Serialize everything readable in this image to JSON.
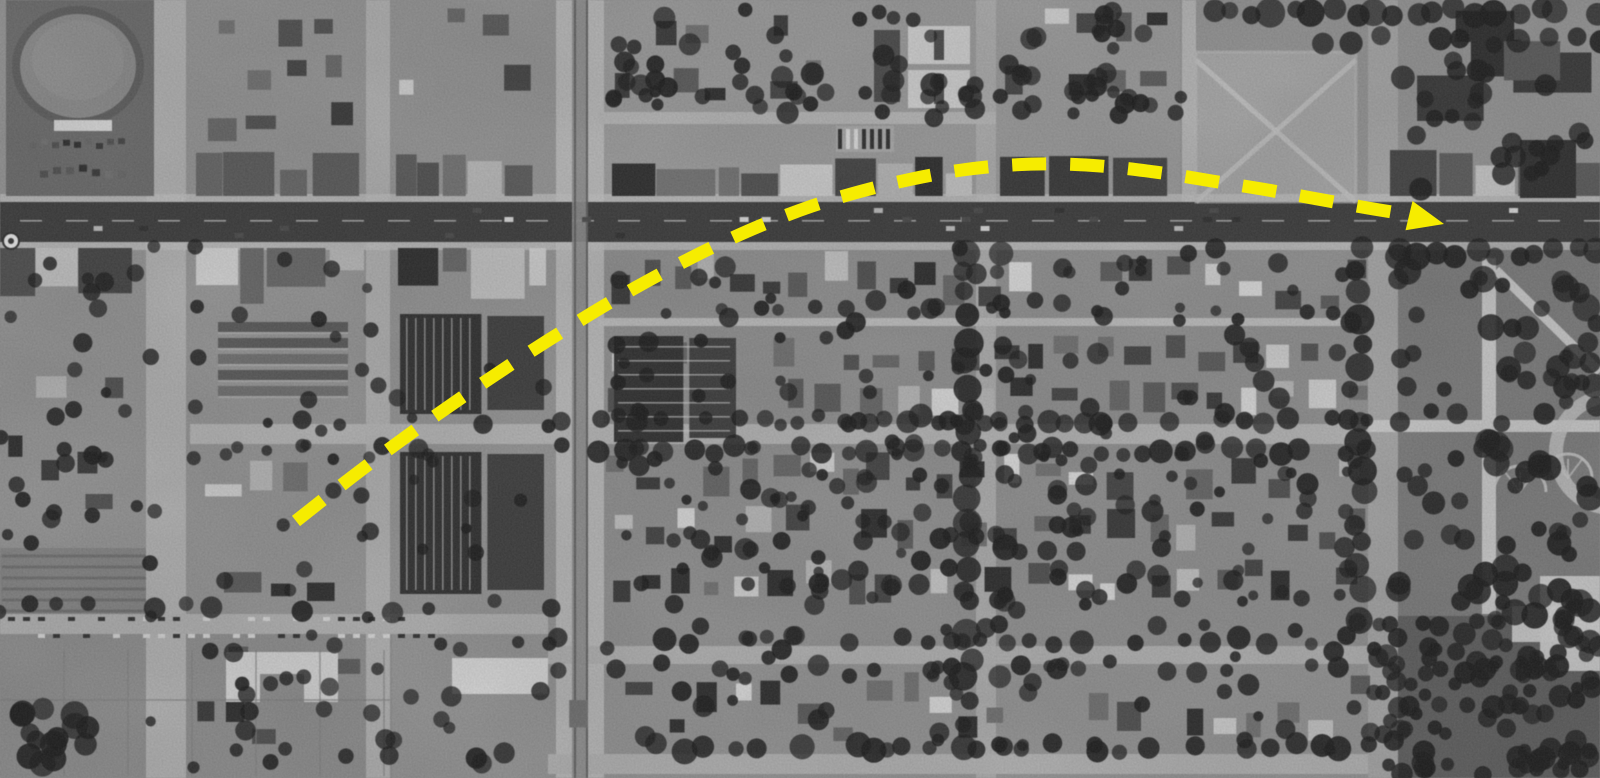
{
  "meta": {
    "kind": "annotated-aerial-photograph",
    "color_mode": "grayscale",
    "width": 1600,
    "height": 778
  },
  "palette": {
    "base": "#949494",
    "road_major": "#3c3c3c",
    "sidewalk": "#c2c2c2",
    "tree": "#1d1d1d",
    "dark_tones": [
      "#2d2d2d",
      "#383838",
      "#434343",
      "#4f4f4f",
      "#5a5a5a",
      "#666666",
      "#717171"
    ],
    "light_tones": [
      "#b7b7b7",
      "#c3c3c3",
      "#cfcfcf",
      "#dadada"
    ],
    "field": "#8d8d8d",
    "park": "#7c7c7c",
    "dark_field": "#5e5e5e",
    "arrow_yellow": "#F6EC00"
  },
  "annotation": {
    "arrow": {
      "color": "#F6EC00",
      "stroke_width": 13,
      "dash_length": 34,
      "gap_length": 24,
      "points": [
        [
          296,
          521
        ],
        [
          352,
          477
        ],
        [
          407,
          436
        ],
        [
          461,
          398
        ],
        [
          513,
          363
        ],
        [
          563,
          331
        ],
        [
          614,
          300
        ],
        [
          664,
          272
        ],
        [
          713,
          247
        ],
        [
          762,
          225
        ],
        [
          812,
          206
        ],
        [
          862,
          191
        ],
        [
          912,
          179
        ],
        [
          962,
          170
        ],
        [
          1012,
          165
        ],
        [
          1062,
          164
        ],
        [
          1112,
          167
        ],
        [
          1162,
          173
        ],
        [
          1212,
          181
        ],
        [
          1262,
          189
        ],
        [
          1312,
          198
        ],
        [
          1362,
          207
        ],
        [
          1404,
          214
        ]
      ],
      "head": {
        "tip": [
          1444,
          224
        ],
        "angle_deg": 13.5,
        "length": 36,
        "width": 30
      }
    }
  },
  "scene": {
    "texture": {
      "seed": 1949,
      "grain_opacity": 0.11,
      "mottle_opacity": 0.12
    },
    "ground_patches": [
      {
        "x": 0,
        "y": 634,
        "w": 392,
        "h": 144,
        "fill": "#8d8d8d",
        "name": "field-bottom-left"
      },
      {
        "x": 0,
        "y": 548,
        "w": 150,
        "h": 86,
        "fill": "#848484",
        "name": "orchard-strip"
      },
      {
        "x": 1196,
        "y": 52,
        "w": 160,
        "h": 150,
        "fill": "#a7a7a7",
        "name": "vacant-lot"
      },
      {
        "x": 1398,
        "y": 244,
        "w": 202,
        "h": 374,
        "fill": "#7c7c7c",
        "name": "park-grounds"
      },
      {
        "x": 1368,
        "y": 616,
        "w": 232,
        "h": 162,
        "fill": "#5e5e5e",
        "name": "dark-park-field"
      },
      {
        "x": 604,
        "y": 246,
        "w": 764,
        "h": 404,
        "fill": "#909090",
        "name": "residential-southeast"
      },
      {
        "x": 600,
        "y": 0,
        "w": 580,
        "h": 196,
        "fill": "#9b9b9b",
        "name": "residential-north"
      }
    ],
    "roads": {
      "main": {
        "x": 0,
        "y": 202,
        "w": 1600,
        "h": 40,
        "tone": "#3c3c3c"
      },
      "sidewalks": [
        {
          "x": 0,
          "y": 194,
          "w": 1600,
          "h": 8
        },
        {
          "x": 0,
          "y": 242,
          "w": 1600,
          "h": 8
        }
      ],
      "horizontal": [
        {
          "x": 190,
          "y": 424,
          "w": 1178,
          "h": 20,
          "tone": "#b5b5b5"
        },
        {
          "x": 0,
          "y": 614,
          "w": 548,
          "h": 20,
          "tone": "#b0b0b0"
        },
        {
          "x": 548,
          "y": 646,
          "w": 820,
          "h": 18,
          "tone": "#b0b0b0"
        },
        {
          "x": 598,
          "y": 318,
          "w": 770,
          "h": 8,
          "tone": "#bdbdbd"
        },
        {
          "x": 598,
          "y": 112,
          "w": 398,
          "h": 12,
          "tone": "#b6b6b6"
        },
        {
          "x": 548,
          "y": 754,
          "w": 820,
          "h": 20,
          "tone": "#b2b2b2"
        }
      ],
      "vertical": [
        {
          "x": 146,
          "y": 0,
          "w": 40,
          "h": 778,
          "tone": "#b2b2b2"
        },
        {
          "x": 366,
          "y": 0,
          "w": 24,
          "h": 778,
          "tone": "#b0b0b0"
        },
        {
          "x": 556,
          "y": 0,
          "w": 48,
          "h": 778,
          "tone": "#b9b9b9"
        },
        {
          "x": 976,
          "y": 0,
          "w": 20,
          "h": 778,
          "tone": "#adadad"
        },
        {
          "x": 1368,
          "y": 0,
          "w": 30,
          "h": 778,
          "tone": "#a6a6a6"
        },
        {
          "x": 1182,
          "y": 0,
          "w": 14,
          "h": 202,
          "tone": "#b6b6b6"
        }
      ],
      "boulevard_median": {
        "x": 572,
        "w": 16,
        "tone": "#8c8c8c",
        "track_xs": [
          574,
          586
        ]
      }
    },
    "zones": [
      {
        "type": "houses",
        "x": 196,
        "y": 6,
        "w": 168,
        "h": 138,
        "rows": 3,
        "density": 0.75,
        "big": true
      },
      {
        "type": "houses",
        "x": 398,
        "y": 4,
        "w": 148,
        "h": 100,
        "rows": 2,
        "density": 0.6
      },
      {
        "type": "houses",
        "x": 612,
        "y": 4,
        "w": 220,
        "h": 100,
        "rows": 2,
        "density": 0.7
      },
      {
        "type": "houses",
        "x": 1000,
        "y": 4,
        "w": 178,
        "h": 102,
        "rows": 2,
        "density": 0.8
      },
      {
        "type": "bigbuildings",
        "x": 1390,
        "y": 6,
        "w": 206,
        "h": 120
      },
      {
        "type": "houses",
        "x": 604,
        "y": 248,
        "w": 764,
        "h": 64,
        "rows": 1,
        "density": 0.85
      },
      {
        "type": "houses",
        "x": 604,
        "y": 332,
        "w": 764,
        "h": 86,
        "rows": 2,
        "density": 0.9
      },
      {
        "type": "houses",
        "x": 604,
        "y": 450,
        "w": 764,
        "h": 158,
        "rows": 3,
        "density": 0.9
      },
      {
        "type": "houses",
        "x": 560,
        "y": 670,
        "w": 808,
        "h": 78,
        "rows": 1,
        "density": 0.85
      },
      {
        "type": "houses",
        "x": 196,
        "y": 450,
        "w": 166,
        "h": 156,
        "rows": 3,
        "density": 0.55,
        "big": true
      },
      {
        "type": "houses",
        "x": 0,
        "y": 310,
        "w": 146,
        "h": 230,
        "rows": 4,
        "density": 0.5,
        "big": true
      },
      {
        "type": "houses",
        "x": 196,
        "y": 640,
        "w": 166,
        "h": 108,
        "rows": 2,
        "density": 0.4
      },
      {
        "type": "commercial",
        "x": 196,
        "y": 150,
        "w": 168,
        "h": 46,
        "align": "bottom"
      },
      {
        "type": "commercial",
        "x": 396,
        "y": 152,
        "w": 150,
        "h": 44,
        "align": "bottom"
      },
      {
        "type": "commercial",
        "x": 612,
        "y": 154,
        "w": 360,
        "h": 42,
        "align": "bottom"
      },
      {
        "type": "commercial",
        "x": 1000,
        "y": 154,
        "w": 180,
        "h": 42,
        "align": "bottom"
      },
      {
        "type": "commercial",
        "x": 1390,
        "y": 150,
        "w": 210,
        "h": 46,
        "align": "bottom"
      },
      {
        "type": "commercial",
        "x": 0,
        "y": 248,
        "w": 144,
        "h": 56,
        "align": "top"
      },
      {
        "type": "commercial",
        "x": 196,
        "y": 248,
        "w": 168,
        "h": 58,
        "align": "top"
      },
      {
        "type": "commercial",
        "x": 398,
        "y": 248,
        "w": 148,
        "h": 54,
        "align": "top"
      },
      {
        "type": "court",
        "x": 214,
        "y": 322,
        "w": 138,
        "h": 90
      },
      {
        "type": "industrial",
        "x": 398,
        "y": 312,
        "w": 148,
        "h": 106,
        "stripes": "v"
      },
      {
        "type": "industrial",
        "x": 398,
        "y": 450,
        "w": 148,
        "h": 148,
        "stripes": "v"
      },
      {
        "type": "industrial",
        "x": 612,
        "y": 334,
        "w": 126,
        "h": 112,
        "stripes": "h"
      }
    ],
    "landmarks": {
      "stadium": {
        "block": [
          6,
          0,
          148,
          196
        ],
        "block_fill": "#6b6b6b",
        "oval_cx": 78,
        "oval_cy": 66,
        "rx": 62,
        "ry": 56,
        "field_fill": "#8a8a8a",
        "ring_stroke": "#5d5d5d",
        "stand": [
          54,
          120,
          58,
          11
        ],
        "stand_fill": "#d6d6d6"
      },
      "apartment_courts": {
        "buildings": [
          [
            908,
            26,
            62,
            38
          ],
          [
            908,
            70,
            62,
            38
          ]
        ],
        "fill": "#d2d2d2",
        "court_fill": "#4a4a4a",
        "neighbor": [
          874,
          30,
          26,
          72
        ]
      },
      "parking_row": {
        "x": 836,
        "y": 126,
        "w": 58,
        "h": 26,
        "step": 8
      },
      "vacant_lot_paths": {
        "rect": [
          1196,
          52,
          160,
          150
        ],
        "stroke": "#c4c4c4"
      },
      "courtyard_building": {
        "rect": [
          226,
          652,
          112,
          50
        ],
        "fill": "#d4d4d4",
        "notch": [
          260,
          674,
          44,
          28
        ]
      },
      "white_building": {
        "rect": [
          452,
          658,
          96,
          36
        ],
        "fill": "#d9d9d9"
      },
      "big_dark_roof": {
        "rect": [
          1520,
          140,
          56,
          58
        ],
        "fill": "#2f2f2f"
      },
      "park": {
        "v_path": [
          1482,
          258,
          14,
          356
        ],
        "h_path": [
          1368,
          420,
          232,
          12
        ],
        "diag": [
          1496,
          270,
          1600,
          372
        ],
        "plaza": [
          [
            1540,
            576,
            60,
            95
          ],
          [
            1512,
            606,
            88,
            36
          ]
        ],
        "fan_beds": [
          [
            1520,
            492,
            26
          ],
          [
            1568,
            478,
            24
          ]
        ],
        "big_circle": {
          "cx": 1612,
          "cy": 452,
          "r": 56
        },
        "path_tone": "#c9c9c9"
      },
      "marker_disc": {
        "cx": 11,
        "cy": 241,
        "r": 8
      },
      "field_grid": {
        "v_xs": [
          64,
          128,
          192,
          256,
          320,
          384
        ],
        "y1": 650,
        "y2": 776,
        "h_lines": [
          [
            0,
            390,
            700
          ]
        ],
        "stroke": "#7e7e7e"
      },
      "orchard_rows": {
        "x1": 2,
        "x2": 146,
        "y_start": 556,
        "y_end": 612,
        "step": 11,
        "stroke": "#6a6a6a"
      },
      "tree_clump": [
        20,
        706,
        70,
        62
      ]
    },
    "tree_lines": [
      [
        600,
        420,
        1368,
        420,
        20,
        6,
        12,
        0.8
      ],
      [
        600,
        450,
        1368,
        450,
        22,
        6,
        12,
        0.7
      ],
      [
        196,
        420,
        560,
        420,
        34,
        5,
        10,
        0.5
      ],
      [
        196,
        450,
        560,
        450,
        36,
        5,
        10,
        0.45
      ],
      [
        560,
        640,
        1368,
        640,
        26,
        6,
        12,
        0.75
      ],
      [
        560,
        670,
        1368,
        670,
        28,
        6,
        11,
        0.55
      ],
      [
        0,
        608,
        548,
        608,
        30,
        6,
        11,
        0.6
      ],
      [
        0,
        640,
        548,
        640,
        34,
        5,
        10,
        0.5
      ],
      [
        560,
        748,
        1368,
        748,
        24,
        7,
        13,
        0.8
      ],
      [
        968,
        250,
        968,
        748,
        22,
        8,
        15,
        0.85
      ],
      [
        1002,
        250,
        1002,
        748,
        24,
        7,
        13,
        0.65
      ],
      [
        1360,
        246,
        1360,
        616,
        24,
        9,
        16,
        0.85
      ],
      [
        1404,
        246,
        1404,
        420,
        26,
        8,
        14,
        0.7
      ],
      [
        150,
        250,
        150,
        770,
        48,
        5,
        10,
        0.5
      ],
      [
        196,
        250,
        196,
        770,
        52,
        5,
        9,
        0.4
      ],
      [
        1400,
        252,
        1595,
        252,
        18,
        8,
        14,
        0.85
      ],
      [
        1210,
        12,
        1600,
        12,
        20,
        8,
        15,
        0.85
      ],
      [
        1300,
        40,
        1600,
        40,
        26,
        7,
        12,
        0.5
      ],
      [
        604,
        310,
        1368,
        310,
        30,
        5,
        9,
        0.5
      ],
      [
        366,
        250,
        366,
        616,
        40,
        5,
        9,
        0.4
      ],
      [
        612,
        96,
        968,
        96,
        34,
        6,
        11,
        0.5
      ],
      [
        1004,
        96,
        1180,
        96,
        30,
        6,
        11,
        0.5
      ]
    ],
    "tree_areas": [
      [
        604,
        246,
        764,
        360,
        150,
        5,
        11
      ],
      [
        604,
        460,
        764,
        290,
        110,
        5,
        11
      ],
      [
        1398,
        250,
        202,
        366,
        85,
        7,
        14
      ],
      [
        1368,
        616,
        232,
        160,
        110,
        6,
        12
      ],
      [
        612,
        8,
        370,
        110,
        45,
        6,
        12
      ],
      [
        1000,
        8,
        180,
        110,
        30,
        6,
        11
      ],
      [
        1390,
        60,
        206,
        130,
        25,
        7,
        12
      ],
      [
        200,
        250,
        350,
        360,
        30,
        5,
        10
      ],
      [
        0,
        250,
        146,
        300,
        28,
        5,
        10
      ],
      [
        200,
        640,
        360,
        130,
        30,
        6,
        11
      ],
      [
        20,
        706,
        70,
        62,
        14,
        8,
        14
      ]
    ],
    "cars": {
      "main_road_lanes": [
        208,
        217,
        226,
        233
      ],
      "main_road_count": 26,
      "main_road_x_range": [
        30,
        1565
      ],
      "parked_row": {
        "x1": 8,
        "x2": 430,
        "y": [
          617,
          634
        ],
        "step": 15,
        "density": 0.65
      }
    }
  }
}
